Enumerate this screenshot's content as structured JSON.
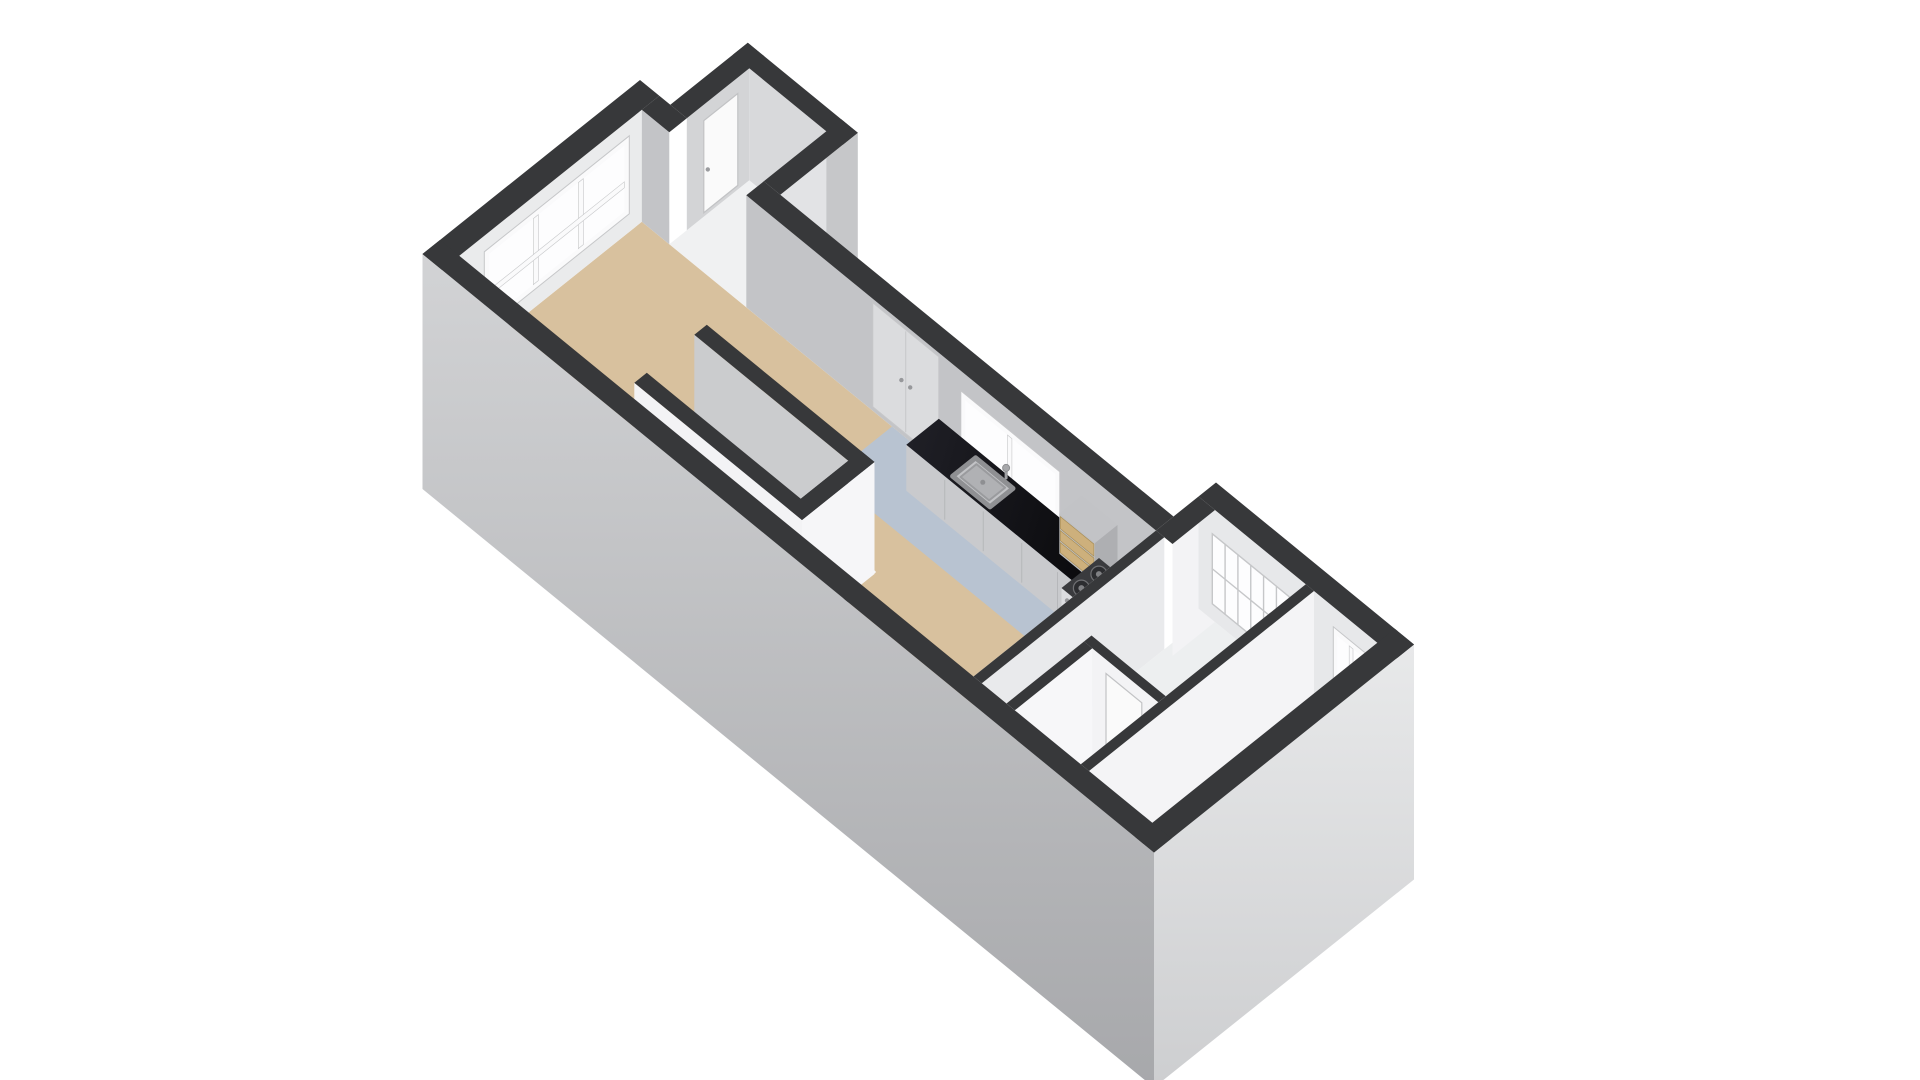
{
  "app": {
    "name": "3d-floorplan-view",
    "background": "#ffffff"
  },
  "floorplan": {
    "view": "3d-axonometric",
    "rooms": [
      {
        "name": "living-room",
        "floor": "wood-beige"
      },
      {
        "name": "kitchen",
        "floor": "blue-gray"
      },
      {
        "name": "hallway",
        "floor": "white"
      },
      {
        "name": "toilet",
        "floor": "white"
      },
      {
        "name": "storage-balcony",
        "floor": "white"
      }
    ],
    "fixtures": [
      "staircase-down",
      "kitchen-counter",
      "kitchen-sink",
      "faucet",
      "gas-stove-4-burners",
      "drawer-cabinet-wood-front",
      "closet-double-doors",
      "kitchen-window",
      "facade-window-wall",
      "glass-block-panel",
      "rear-window",
      "interior-doors"
    ],
    "colors": {
      "background": "#ffffff",
      "wall_top": "#37383a",
      "ext_wall_light": "#d2d3d5",
      "ext_wall_dark": "#a7a8ab",
      "ext_end_light": "#e8e9ea",
      "ext_end_dark": "#cdced0",
      "protrusion_ext": "#c6c7c9",
      "ne_wall_face": "#c3c4c7",
      "facade_face": "#eaebec",
      "white_face": "#f3f3f5",
      "inner_gray": "#cbccce",
      "floor_wood": "#d8c19e",
      "floor_kitchen": "#b8c3d1",
      "floor_white": "#edeff0",
      "floor_storage": "#f0f1f2",
      "counter_black_1": "#070709",
      "counter_black_2": "#202027",
      "counter_front": "#c9cacd",
      "cabinet_tan": "#cdb07c",
      "cabinet_tan_dark": "#a98f58",
      "stove_top": "#3a3b3e",
      "stove_front": "#dcdde0",
      "metal": "#b9babd",
      "metal_dark": "#8f9093",
      "tread": "#f4f4f6",
      "riser": "#d9dadc",
      "pit": "#141417",
      "glass": "#fdfdfe",
      "frame": "#fafafb",
      "frame_line": "#c6c7c9",
      "door_white": "#fafafa",
      "door_line": "#c2c3c5",
      "handle": "#9b9c9f"
    }
  }
}
